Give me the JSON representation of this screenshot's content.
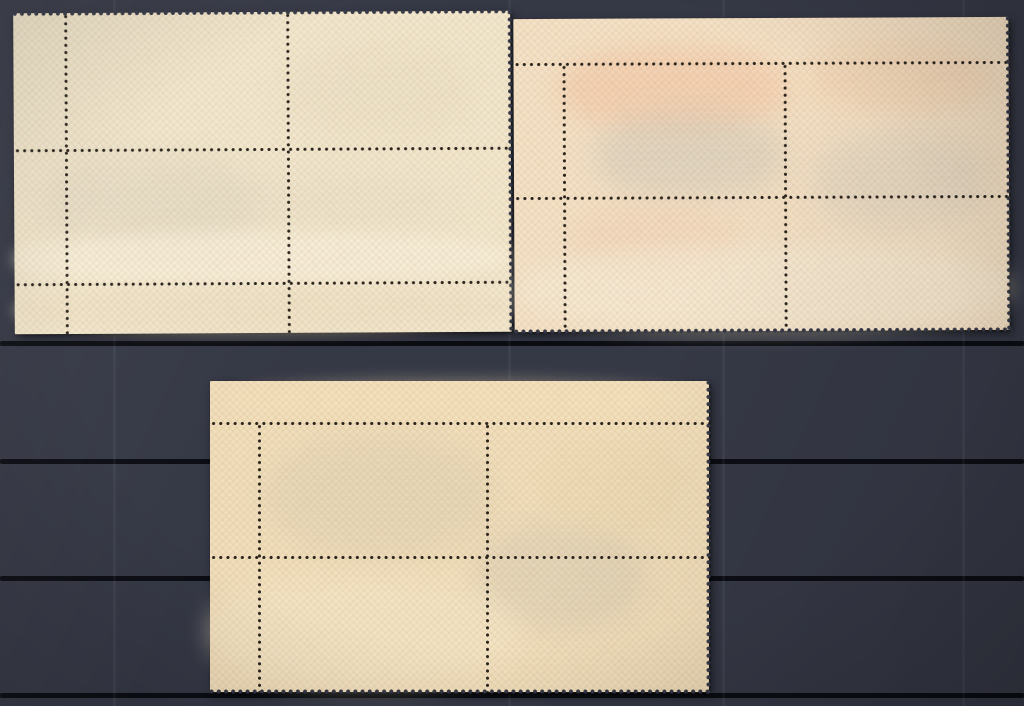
{
  "scene": {
    "description": "Photograph of three mint postage-stamp corner blocks of four, shown gum side up with selvedge margins and perforations, arranged on a dark stockbook page with horizontal slot lines",
    "canvas": {
      "width": 1024,
      "height": 706
    },
    "background": {
      "base_color": "#353845",
      "slot_line_color": "#0b0d13",
      "slot_line_ys": [
        341,
        459,
        576,
        693
      ],
      "slot_line_height": 5,
      "sheen_color": "rgba(255,255,255,0.045)",
      "sheen_xs": [
        113,
        508,
        722,
        962
      ]
    },
    "perforation": {
      "dot_color": "#2a241d",
      "dot_spacing": 7.2,
      "dot_radius": 1.35,
      "tooth_radius": 1.8
    },
    "blocks": [
      {
        "id": "top-left",
        "label": "top-left block of four, pale cream gum, selvedge at left and bottom",
        "x": 14,
        "y": 12,
        "width": 497,
        "height": 321,
        "tilt_deg": -0.3,
        "paper_color": "#f1e6cc",
        "perf_cols": [
          {
            "x": 52,
            "y1": 0,
            "y2": 321
          },
          {
            "x": 274,
            "y1": 0,
            "y2": 321
          }
        ],
        "perf_rows": [
          {
            "y": 137,
            "x1": 0,
            "x2": 497
          },
          {
            "y": 271,
            "x1": 0,
            "x2": 497
          }
        ],
        "torn_edges": [
          "top",
          "right"
        ],
        "patches": [
          {
            "x": 30,
            "y": 140,
            "w": 210,
            "h": 100,
            "color": "#ddd3c0",
            "opacity": 0.45,
            "blur": 14
          },
          {
            "x": 270,
            "y": 35,
            "w": 190,
            "h": 90,
            "color": "#e6dac0",
            "opacity": 0.4,
            "blur": 14
          },
          {
            "x": 60,
            "y": 160,
            "w": 380,
            "h": 60,
            "color": "#e3d9c3",
            "opacity": 0.35,
            "blur": 16
          },
          {
            "x": 0,
            "y": 220,
            "w": 497,
            "h": 52,
            "color": "#f8efdc",
            "opacity": 0.65,
            "blur": 7
          },
          {
            "x": 0,
            "y": 272,
            "w": 497,
            "h": 49,
            "color": "#ecdec2",
            "opacity": 0.55,
            "blur": 6
          }
        ]
      },
      {
        "id": "top-right",
        "label": "top-right block of four, cream gum with salmon show-through, selvedge at top and left",
        "x": 514,
        "y": 18,
        "width": 495,
        "height": 313,
        "tilt_deg": -0.25,
        "paper_color": "#f3e0c5",
        "perf_cols": [
          {
            "x": 50,
            "y1": 45,
            "y2": 313
          },
          {
            "x": 271,
            "y1": 45,
            "y2": 313
          }
        ],
        "perf_rows": [
          {
            "y": 45,
            "x1": 0,
            "x2": 495
          },
          {
            "y": 179,
            "x1": 0,
            "x2": 495
          }
        ],
        "torn_edges": [
          "bottom",
          "right"
        ],
        "patches": [
          {
            "x": 45,
            "y": 28,
            "w": 230,
            "h": 85,
            "color": "#f2c6a5",
            "opacity": 0.6,
            "blur": 12
          },
          {
            "x": 290,
            "y": 25,
            "w": 190,
            "h": 70,
            "color": "#f2cfae",
            "opacity": 0.5,
            "blur": 12
          },
          {
            "x": 80,
            "y": 95,
            "w": 190,
            "h": 85,
            "color": "#cdc7b9",
            "opacity": 0.5,
            "blur": 14
          },
          {
            "x": 300,
            "y": 115,
            "w": 175,
            "h": 95,
            "color": "#d5cdbf",
            "opacity": 0.4,
            "blur": 14
          },
          {
            "x": 55,
            "y": 185,
            "w": 170,
            "h": 70,
            "color": "#efccb0",
            "opacity": 0.35,
            "blur": 12
          },
          {
            "x": 0,
            "y": 228,
            "w": 495,
            "h": 85,
            "color": "#f5ecd8",
            "opacity": 0.55,
            "blur": 10
          }
        ]
      },
      {
        "id": "bottom-center",
        "label": "bottom block of four, buff-orange gum with crosshatch texture, selvedge at top and left",
        "x": 210,
        "y": 381,
        "width": 499,
        "height": 311,
        "tilt_deg": 0,
        "paper_color": "#f0ddba",
        "perf_cols": [
          {
            "x": 49,
            "y1": 42,
            "y2": 311
          },
          {
            "x": 277,
            "y1": 42,
            "y2": 311
          }
        ],
        "perf_rows": [
          {
            "y": 42,
            "x1": 0,
            "x2": 499
          },
          {
            "y": 176,
            "x1": 0,
            "x2": 499
          }
        ],
        "torn_edges": [
          "bottom",
          "right"
        ],
        "patches": [
          {
            "x": 20,
            "y": 0,
            "w": 460,
            "h": 38,
            "color": "#f6e4bd",
            "opacity": 0.45,
            "blur": 8
          },
          {
            "x": 55,
            "y": 55,
            "w": 230,
            "h": 120,
            "color": "#d8ccb1",
            "opacity": 0.4,
            "blur": 14
          },
          {
            "x": 265,
            "y": 140,
            "w": 170,
            "h": 110,
            "color": "#cdc4b2",
            "opacity": 0.35,
            "blur": 14
          },
          {
            "x": 330,
            "y": 60,
            "w": 150,
            "h": 90,
            "color": "#e9d7ae",
            "opacity": 0.4,
            "blur": 12
          },
          {
            "x": 0,
            "y": 195,
            "w": 310,
            "h": 110,
            "color": "#f4e7ca",
            "opacity": 0.5,
            "blur": 12
          }
        ]
      }
    ]
  }
}
